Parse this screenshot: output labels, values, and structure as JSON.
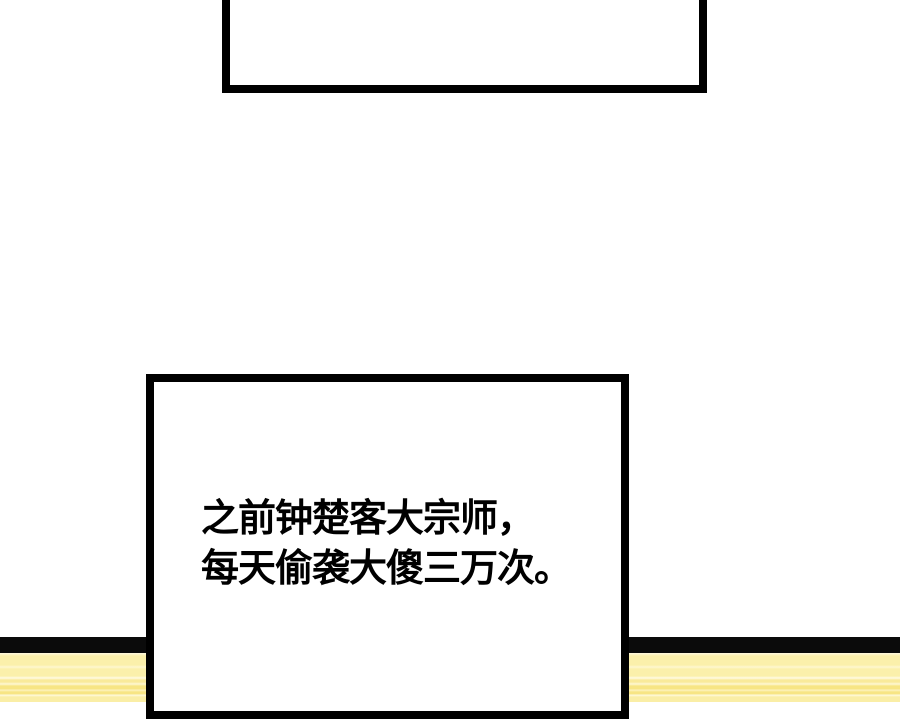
{
  "page": {
    "type": "comic-panel",
    "background_color": "#ffffff",
    "ink_color": "#000000"
  },
  "top_bubble": {
    "description": "empty speech box cropped by top edge",
    "text": ""
  },
  "dialogue_bubble": {
    "lines": [
      "之前钟楚客大宗师，",
      "每天偷袭大傻三万次。"
    ]
  },
  "floor": {
    "edge_color": "#0b0b0b",
    "stripe_base_color": "#fbf0ab",
    "stripe_highlight_color": "#fffbe4",
    "stripe_shadow_color": "#f7e584"
  }
}
